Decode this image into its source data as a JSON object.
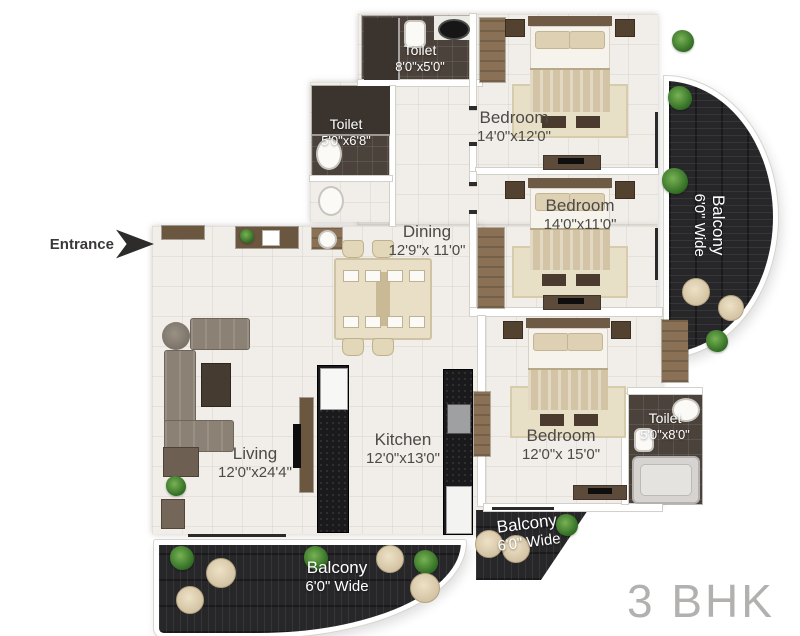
{
  "annotations": {
    "entrance": "Entrance",
    "plan_type": "3 BHK"
  },
  "rooms": {
    "toilet_top": {
      "name": "Toilet",
      "dims": "8'0\"x5'0\""
    },
    "toilet_mid": {
      "name": "Toilet",
      "dims": "5'0\"x6'8\""
    },
    "bedroom_top": {
      "name": "Bedroom",
      "dims": "14'0\"x12'0\""
    },
    "bedroom_mid": {
      "name": "Bedroom",
      "dims": "14'0\"x11'0\""
    },
    "bedroom_bottom": {
      "name": "Bedroom",
      "dims": "12'0\"x 15'0\""
    },
    "toilet_bottom": {
      "name": "Toilet",
      "dims": "5'0\"x8'0\""
    },
    "dining": {
      "name": "Dining",
      "dims": "12'9\"x 11'0\""
    },
    "living": {
      "name": "Living",
      "dims": "12'0\"x24'4\""
    },
    "kitchen": {
      "name": "Kitchen",
      "dims": "12'0\"x13'0\""
    },
    "balcony_right": {
      "name": "Balcony",
      "dims": "6'0\" Wide"
    },
    "balcony_bottom": {
      "name": "Balcony",
      "dims": "6'0\" Wide"
    },
    "balcony_small": {
      "name": "Balcony",
      "dims": "6'0\" Wide"
    }
  },
  "palette": {
    "floor": "#f1eee9",
    "toilet_tile": "#4b423b",
    "deck": "#27272a",
    "wood": "#8a7156",
    "label_dark": "#4c4a47",
    "label_light": "#ffffff",
    "plan_type_gray": "#b2b1af"
  }
}
